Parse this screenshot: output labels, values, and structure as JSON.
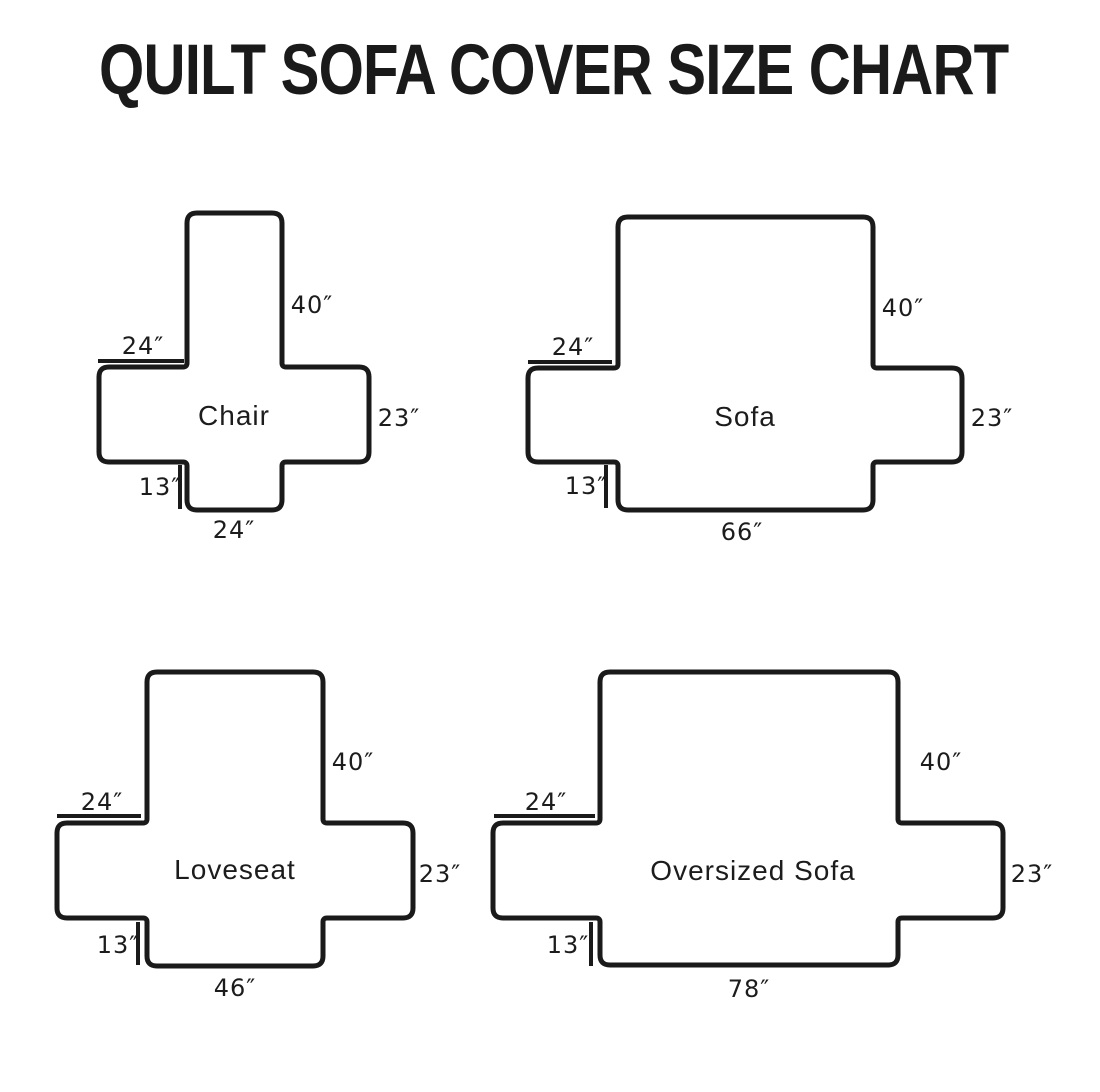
{
  "title": "QUILT SOFA COVER SIZE CHART",
  "colors": {
    "ink": "#1a1a1a",
    "background": "#ffffff"
  },
  "diagrams": [
    {
      "name": "Chair",
      "back_height": "40″",
      "arm_width": "24″",
      "side_height": "23″",
      "skirt_drop": "13″",
      "bottom_width": "24″"
    },
    {
      "name": "Sofa",
      "back_height": "40″",
      "arm_width": "24″",
      "side_height": "23″",
      "skirt_drop": "13″",
      "bottom_width": "66″"
    },
    {
      "name": "Loveseat",
      "back_height": "40″",
      "arm_width": "24″",
      "side_height": "23″",
      "skirt_drop": "13″",
      "bottom_width": "46″"
    },
    {
      "name": "Oversized Sofa",
      "back_height": "40″",
      "arm_width": "24″",
      "side_height": "23″",
      "skirt_drop": "13″",
      "bottom_width": "78″"
    }
  ]
}
